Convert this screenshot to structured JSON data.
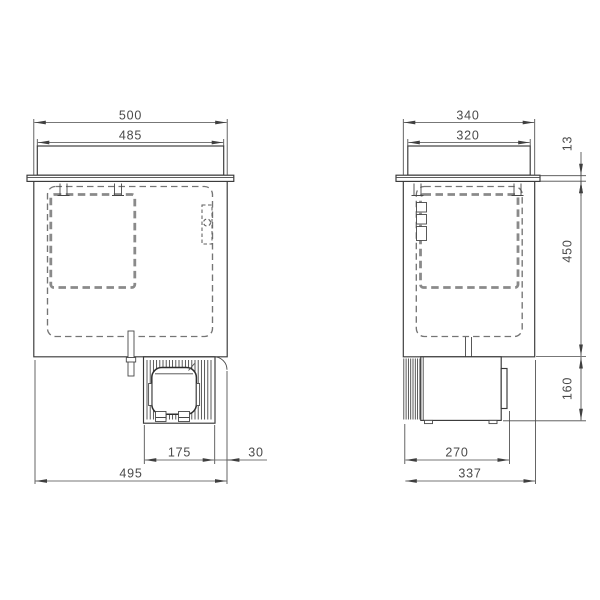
{
  "drawing": {
    "type": "technical-dimension-drawing",
    "colors": {
      "background": "#ffffff",
      "line": "#3a3a3a",
      "dash": "#8a8a8a",
      "dimension": "#4a4a4a"
    },
    "views": {
      "front": "front-view",
      "side": "side-view"
    },
    "dims": {
      "front": {
        "overall_width": "500",
        "lid_width": "485",
        "compressor_width": "175",
        "rear_offset": "30",
        "bottom_width": "495"
      },
      "side": {
        "overall_depth": "340",
        "lid_depth": "320",
        "worktop_thickness": "13",
        "body_height": "450",
        "compressor_height": "160",
        "compressor_depth": "270",
        "bottom_depth": "337"
      }
    }
  }
}
